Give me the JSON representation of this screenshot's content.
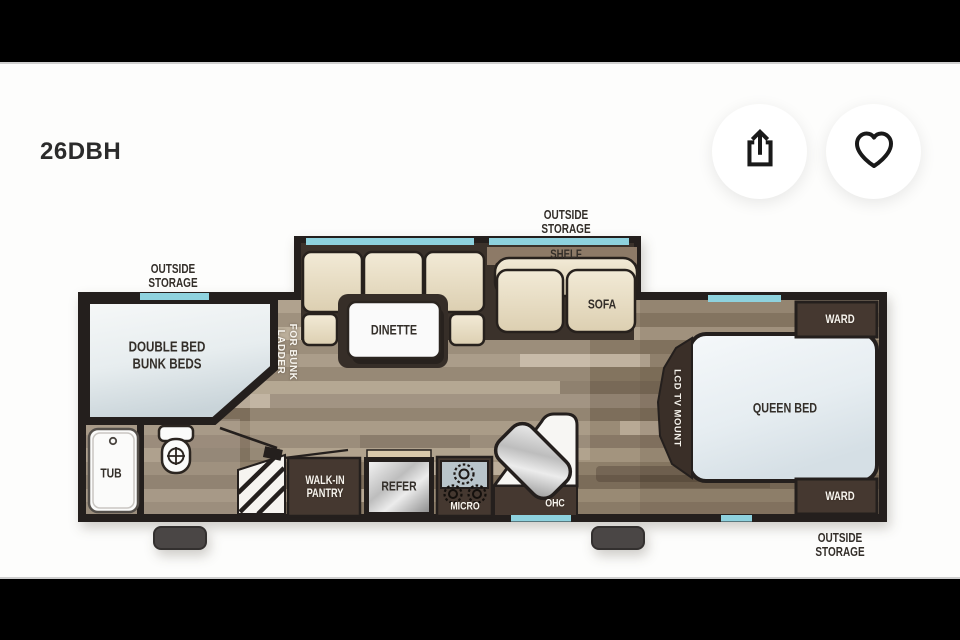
{
  "window": {
    "letterbox_color": "#000000",
    "canvas_color": "#fdfdfc"
  },
  "listing": {
    "model_code": "26DBH"
  },
  "actions": {
    "share_icon": "share-icon",
    "favorite_icon": "heart-icon"
  },
  "floorplan": {
    "labels": {
      "outside_storage_left": {
        "line1": "OUTSIDE",
        "line2": "STORAGE"
      },
      "outside_storage_top": {
        "line1": "OUTSIDE",
        "line2": "STORAGE"
      },
      "outside_storage_right": {
        "line1": "OUTSIDE",
        "line2": "STORAGE"
      },
      "shelf": "SHELF",
      "sofa": "SOFA",
      "dinette": "DINETTE",
      "double_bed_bunk": {
        "line1": "DOUBLE BED",
        "line2": "BUNK BEDS"
      },
      "ladder": {
        "line1": "LADDER",
        "line2": "FOR BUNK"
      },
      "wardrobe_top": "WARD",
      "wardrobe_bottom": "WARD",
      "queen_bed": "QUEEN BED",
      "lcd_tv_mount": "LCD TV MOUNT",
      "tub": "TUB",
      "walk_in_pantry": {
        "line1": "WALK-IN",
        "line2": "PANTRY"
      },
      "refrigerator": "REFER",
      "microwave": "MICRO",
      "overhead_cabinet": "OHC"
    },
    "colors": {
      "wall": "#241f1d",
      "window_accent": "#8ed2de",
      "wood_floor": "#9a8b77",
      "cushion_cream": "#ece2ca",
      "dark_cabinet": "#453830",
      "bed_surface": "#e9eff2",
      "appliance_silver": "#c7c7c7"
    }
  }
}
